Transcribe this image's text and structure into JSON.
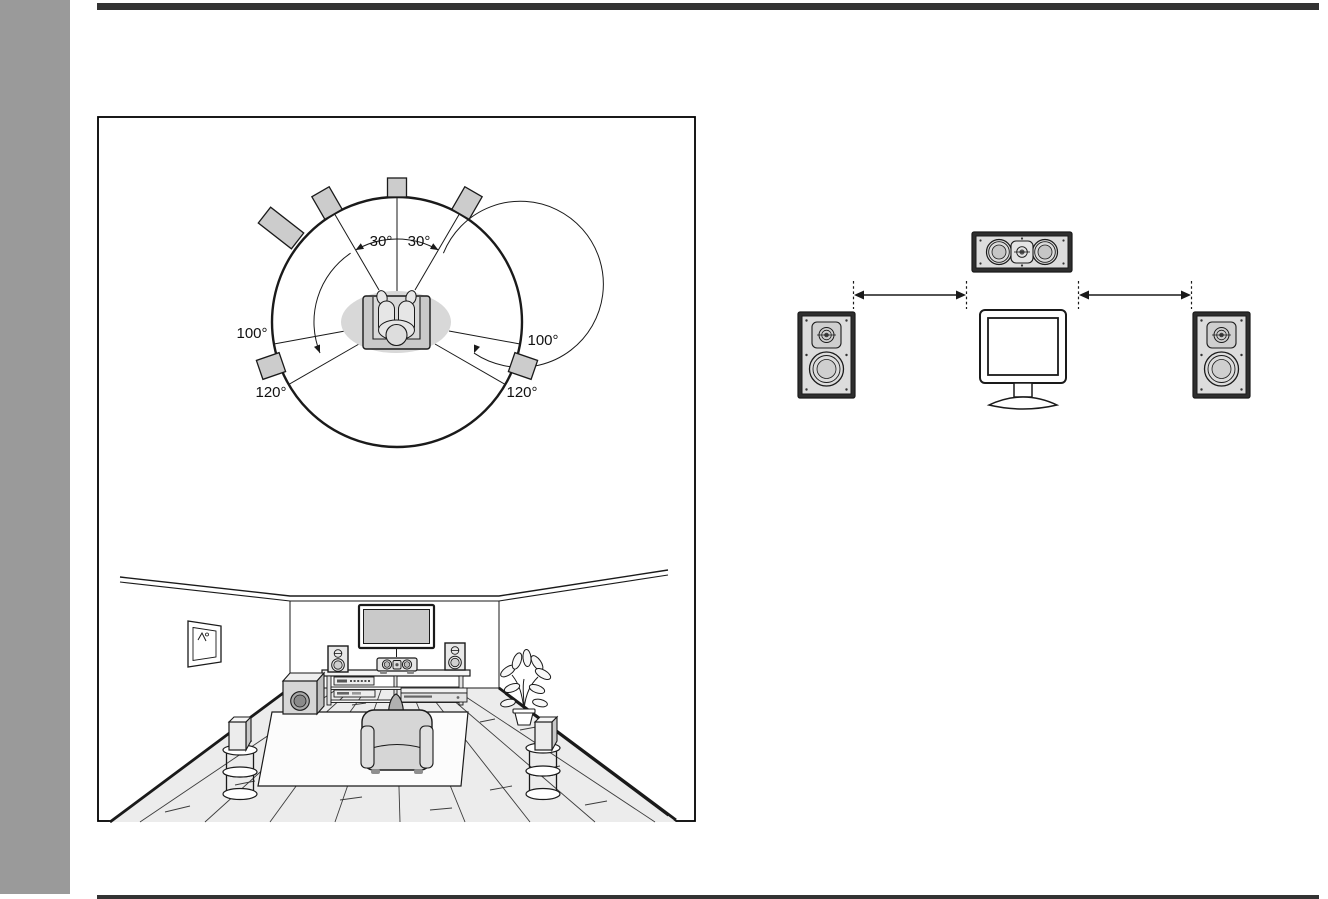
{
  "page": {
    "background": "#ffffff",
    "sidebar_color": "#9a9a9a",
    "rule_color": "#333333",
    "ink_color": "#1a1a1a",
    "speaker_fill": "#cccccc"
  },
  "angle_diagram": {
    "labels": {
      "front_left": "30°",
      "front_right": "30°",
      "surround_left": "100°",
      "surround_right": "100°",
      "surround_back_left": "120°",
      "surround_back_right": "120°"
    }
  }
}
